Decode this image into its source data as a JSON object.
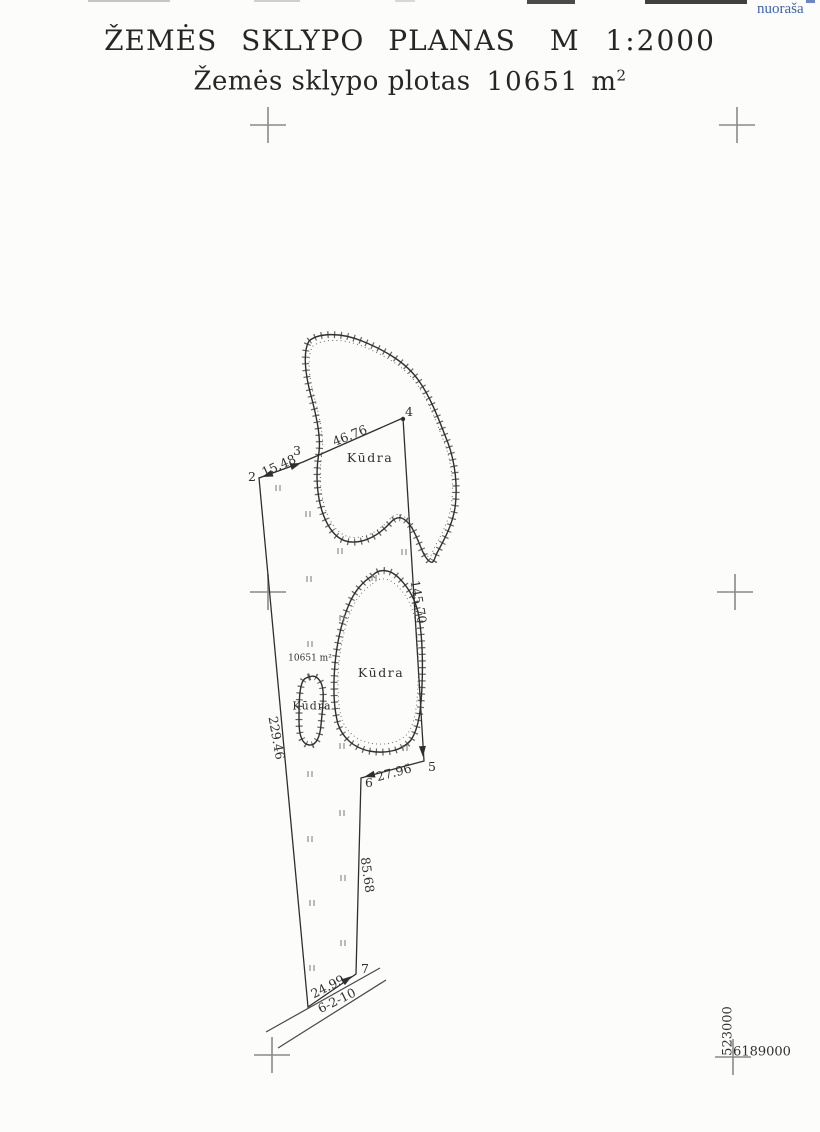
{
  "document": {
    "copy_stamp": "nuoraša",
    "title": "ŽEMĖS SKLYPO PLANAS",
    "scale": "M 1:2000",
    "area_caption": "Žemės sklypo plotas",
    "area_value": "10651",
    "area_unit_base": "m",
    "area_unit_exponent": "2"
  },
  "plan": {
    "parcel_area_label": "10651 m²",
    "pond_top_label": "Kūdra",
    "pond_middle_label": "Kūdra",
    "pond_small_label": "Kūdra",
    "road_number": "6-2-10",
    "vertex_2": "2",
    "vertex_3": "3",
    "vertex_4": "4",
    "vertex_5": "5",
    "vertex_6": "6",
    "vertex_7": "7",
    "len_2_3": "15.48",
    "len_3_4": "46.76",
    "len_4_5": "145.70",
    "len_5_6": "27.96",
    "len_6_7": "85.68",
    "len_7_1": "24.99",
    "len_1_2": "229.46",
    "grid_easting": "523000",
    "grid_northing": "6189000"
  },
  "colors": {
    "ink": "#2f2f2f",
    "stamp_blue": "#3c64ad",
    "grid_gray": "#8a8a8a"
  }
}
